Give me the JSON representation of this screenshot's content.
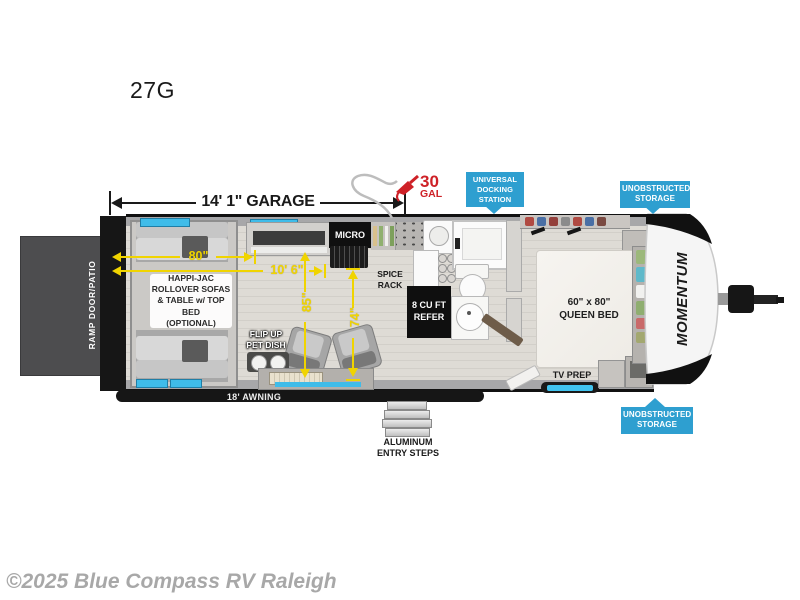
{
  "title": "27G",
  "copyright": "©2025 Blue Compass RV Raleigh",
  "brand_logo": "MOMENTUM",
  "dimensions": {
    "garage_length": "14' 1\" GARAGE",
    "sofa_width": "80\"",
    "living_width": "10' 6\"",
    "garage_height": "85\"",
    "living_height": "74\""
  },
  "fuel_station": {
    "amount": "30",
    "unit": "GAL"
  },
  "feature_badges": {
    "universal_docking_station": "UNIVERSAL\nDOCKING\nSTATION",
    "unobstructed_storage_top": "UNOBSTRUCTED\nSTORAGE",
    "unobstructed_storage_bottom": "UNOBSTRUCTED\nSTORAGE"
  },
  "labels": {
    "ramp_door": "RAMP DOOR/PATIO",
    "happijac_sofas": "HAPPI-JAC\nROLLOVER SOFAS\n& TABLE w/ TOP BED\n(OPTIONAL)",
    "microwave": "MICRO",
    "spice_rack": "SPICE\nRACK",
    "refrigerator": "8 CU FT\nREFER",
    "pet_dish": "FLIP UP\nPET DISH",
    "queen_bed": "60\" x 80\"\nQUEEN BED",
    "tv_prep": "TV PREP",
    "awning": "18' AWNING",
    "entry_steps": "ALUMINUM\nENTRY STEPS"
  },
  "colors": {
    "badge_blue": "#2E9FD0",
    "dimension_yellow": "#F0D400",
    "fuel_red": "#CE2127",
    "window_cyan": "#3FBCE9"
  }
}
